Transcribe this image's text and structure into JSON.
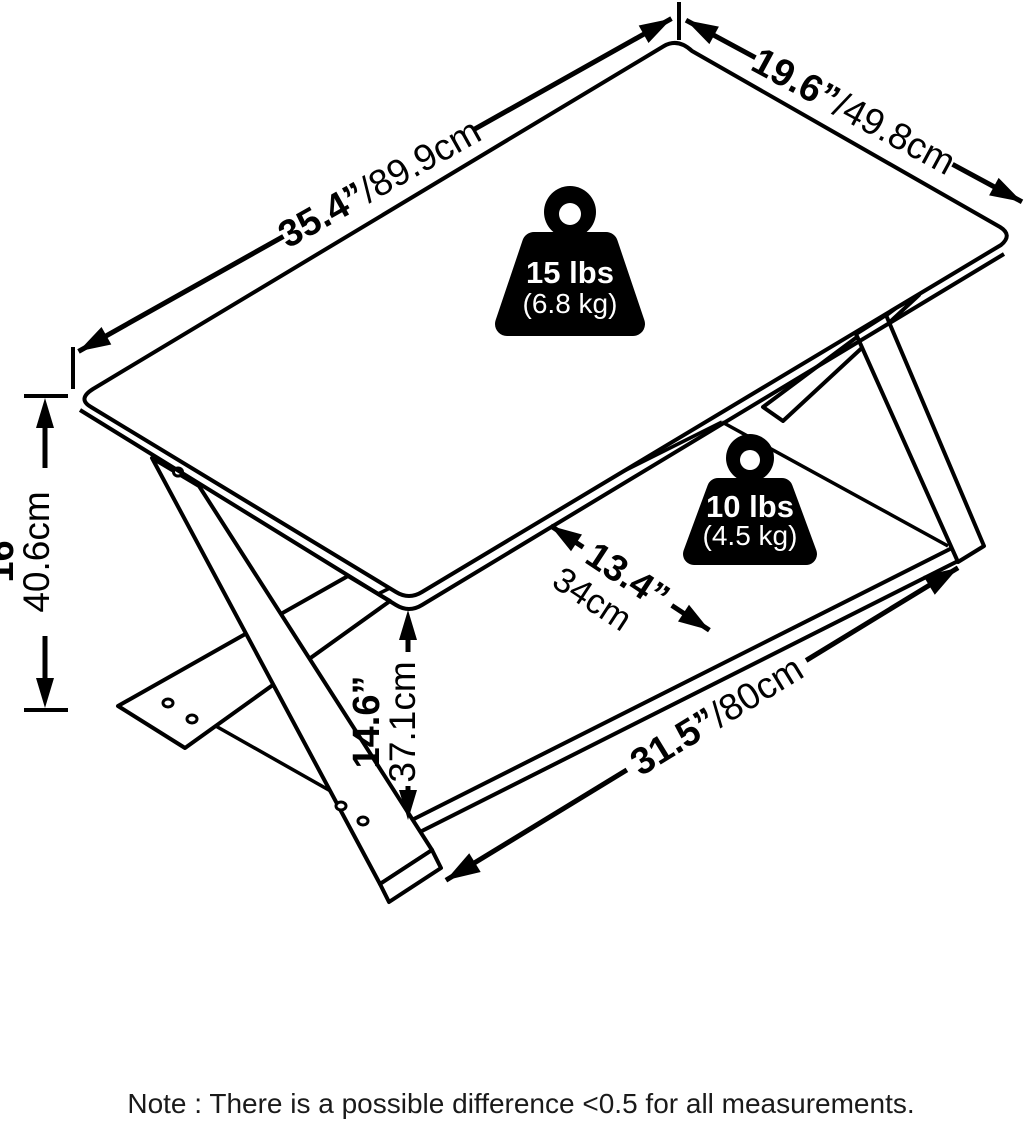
{
  "diagram": {
    "type": "product-dimension-diagram",
    "product": "two-tier cross-leg coffee table",
    "colors": {
      "line": "#000000",
      "background": "#ffffff",
      "weight_fill": "#000000",
      "weight_text": "#ffffff"
    },
    "dims": {
      "top_width": {
        "in": "35.4”",
        "cm": "/89.9cm"
      },
      "top_depth": {
        "in": "19.6”",
        "cm": "/49.8cm"
      },
      "height": {
        "in": "16”",
        "cm": "40.6cm"
      },
      "shelf_height": {
        "in": "14.6”",
        "cm": "37.1cm"
      },
      "shelf_depth": {
        "in": "13.4”",
        "cm": "34cm"
      },
      "shelf_width": {
        "in": "31.5”",
        "cm": "/80cm"
      }
    },
    "weights": {
      "top": {
        "lbs": "15 lbs",
        "kg": "(6.8 kg)"
      },
      "shelf": {
        "lbs": "10 lbs",
        "kg": "(4.5 kg)"
      }
    },
    "note": "Note : There is a possible difference <0.5 for all measurements."
  }
}
